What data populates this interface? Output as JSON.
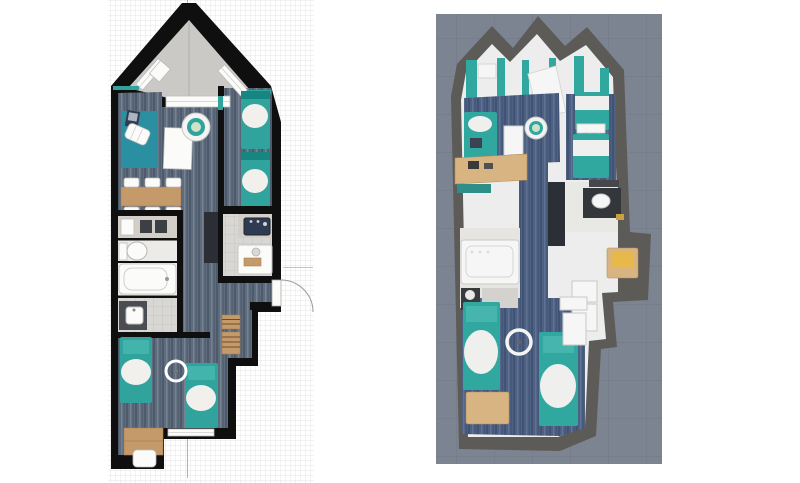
{
  "page": {
    "background": "#ffffff"
  },
  "panels": {
    "plan2d": {
      "view": "2d-top-view-floor-plan",
      "rooms": [
        "balcony",
        "living-dining-room",
        "bedroom-right",
        "bathroom-block",
        "shower-room",
        "corridor",
        "bedroom-bottom",
        "desk-nook"
      ],
      "furniture_icons": [
        "curtain",
        "window",
        "sliding-door-threshold",
        "area-rug",
        "lounge-chair",
        "laptop",
        "coffee-table",
        "swivel-chair",
        "dining-table",
        "dining-chair",
        "single-bed",
        "kitchen-counter",
        "cooktop",
        "toilet",
        "bathtub",
        "corner-shower",
        "wash-basin",
        "vanity-sink",
        "shower-tray",
        "tall-cabinet",
        "ladder-shelf",
        "ceiling-light",
        "desk",
        "desk-chair",
        "entry-door",
        "door-swing-arc",
        "dimension-line"
      ],
      "colors": {
        "wall": "#0f0f0f",
        "grid_line": "#e4e4e4",
        "carpet_base": "#5e6c7e",
        "carpet_dark": "#4c5a6c",
        "carpet_light": "#76828f",
        "rug": "#2b8fa2",
        "bed_teal": "#2fa39c",
        "bed_teal_dark": "#158680",
        "bed_pillow_teal": "#43b4ab",
        "duvet": "#f2f0ec",
        "wood": "#c59a6a",
        "balcony_floor": "#cac9c6",
        "tile": "#d8d7d4",
        "tile_line": "#c3c2bf",
        "counter": "#d3cfc8",
        "appliance_dark": "#3c3f44",
        "cabinet_dark": "#2b2e35",
        "fixture_white": "#fbfbfa",
        "sink_navy": "#2f3b50"
      }
    },
    "plan3d": {
      "view": "3d-aerial-floor-plan",
      "rooms": [
        "gable-left",
        "gable-center",
        "gable-right",
        "living-room",
        "bedroom-right",
        "bathroom-right",
        "bathroom-left",
        "corridor",
        "bedroom-bottom"
      ],
      "furniture_icons": [
        "curtain",
        "loft-bed",
        "daybed",
        "laptop",
        "coffee-table",
        "swivel-chair",
        "single-bed",
        "kitchen-counter",
        "bench",
        "tall-cabinet",
        "vanity-sink",
        "mirror",
        "bathtub",
        "washing-machine",
        "yellow-desk",
        "entry-door",
        "ceiling-light",
        "desk",
        "window"
      ],
      "colors": {
        "background": "#7c8492",
        "bg_grid": "#707987",
        "wall": "#5d5b57",
        "inner": "#ecedec",
        "carpet_base": "#4e6183",
        "carpet_dark": "#405374",
        "carpet_light": "#5f7292",
        "bed_teal": "#30a8a0",
        "bed_pillow": "#45b5ad",
        "duvet": "#eff0ee",
        "wood": "#d9b483",
        "yellow": "#e7b84a",
        "cabinet_dark": "#2b2f36",
        "vanity_dark": "#33363b",
        "fixture": "#f5f6f5",
        "tile": "#e8e8e5"
      }
    }
  }
}
